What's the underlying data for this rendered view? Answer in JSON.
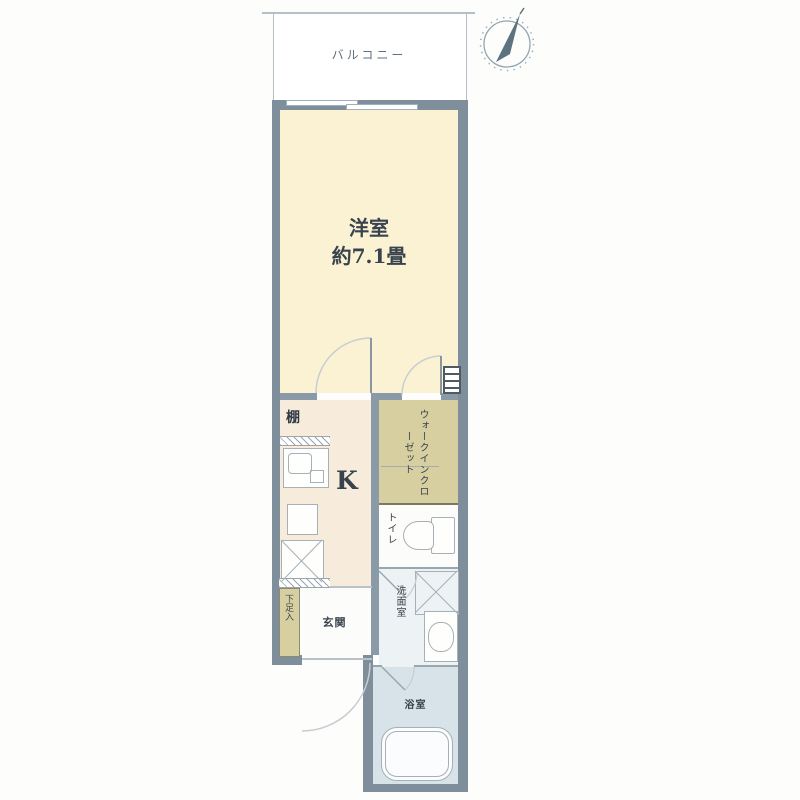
{
  "title": "1K apartment floor plan",
  "compass": "north-arrow",
  "rooms": {
    "balcony": {
      "label": "バルコニー"
    },
    "main_room": {
      "name": "洋室",
      "size": "約7.1畳"
    },
    "kitchen": {
      "label": "K"
    },
    "walk_in_closet": {
      "label": "ウォークインクローゼット"
    },
    "toilet": {
      "label": "トイレ"
    },
    "washroom": {
      "label": "洗面室"
    },
    "bathroom": {
      "label": "浴室"
    },
    "entrance": {
      "label": "玄関"
    },
    "shoe_storage": {
      "label": "下足入"
    },
    "shelf": {
      "label": "棚"
    }
  },
  "colors": {
    "wall": "#7e8f9b",
    "iwall": "#8a9aa6",
    "cream": "#faf2d3",
    "peach": "#f7ebdb",
    "tan": "#d8cfa1",
    "white-room": "#fcfcfa",
    "washroom": "#edf2f4",
    "bath": "#d7e2e9",
    "fixline": "#a6b0b6",
    "arc": "#c6cdd3",
    "text": "#38434d",
    "balcony-line": "#b4bfc7"
  }
}
